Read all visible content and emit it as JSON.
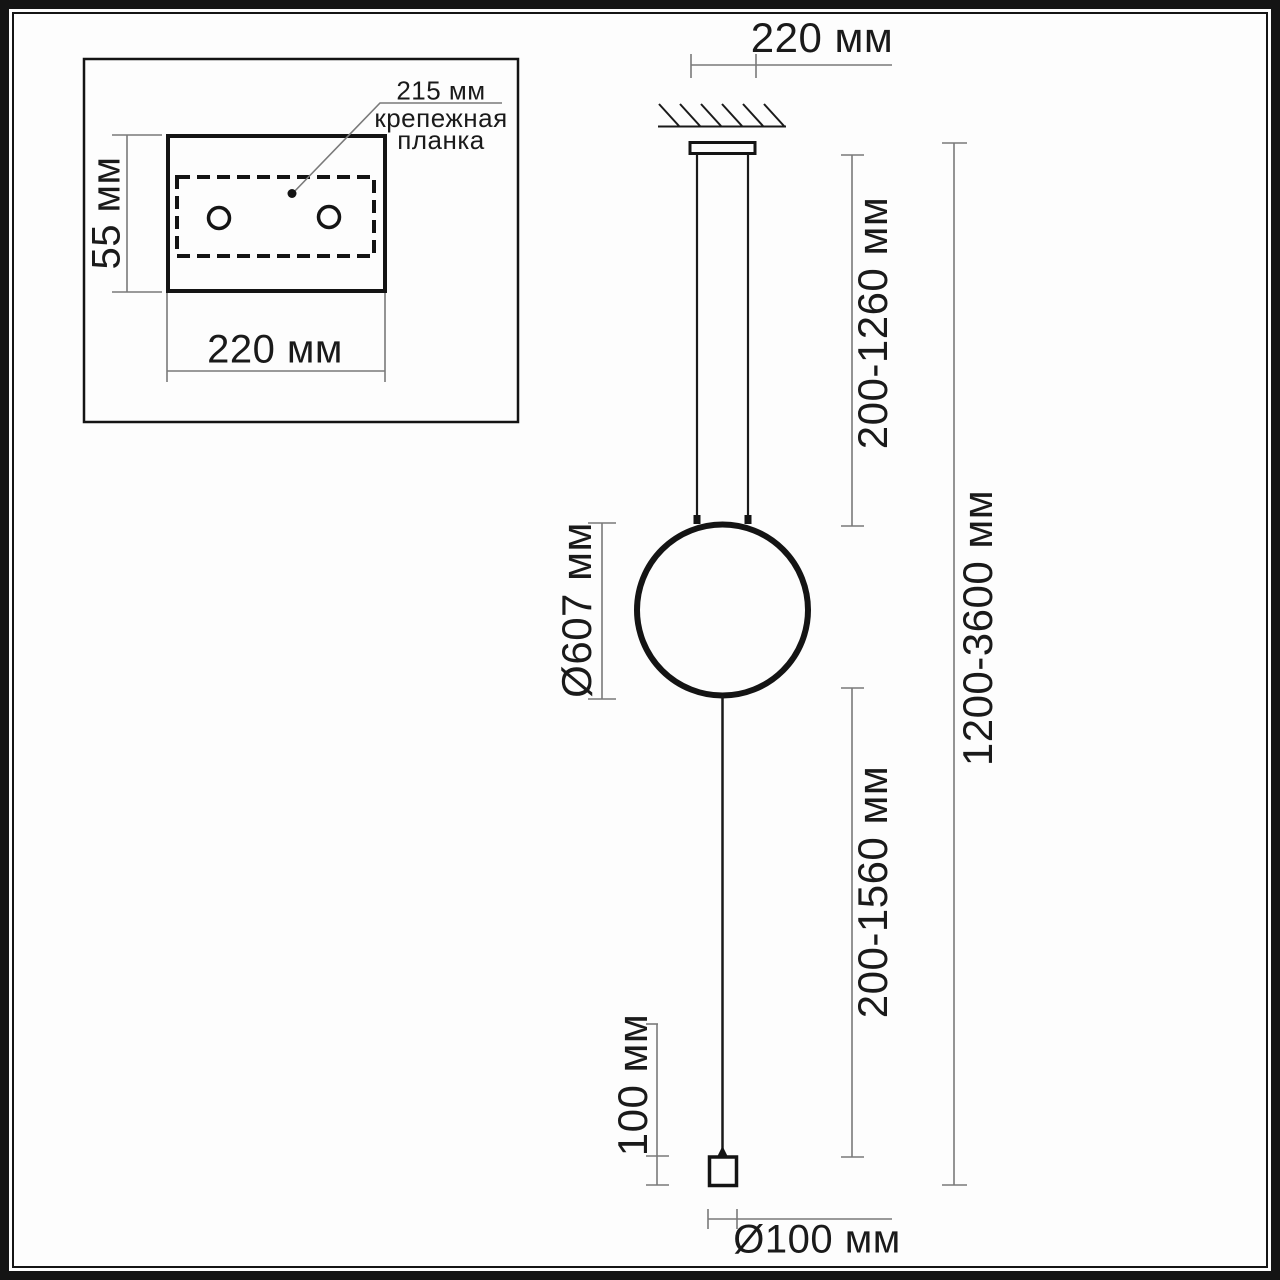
{
  "colors": {
    "line": "#1a1a1a",
    "dim_line": "#7a7a7a",
    "background": "#fdfdfd"
  },
  "inset": {
    "plate_length_label": "215 мм",
    "plate_name_line1": "крепежная",
    "plate_name_line2": "планка",
    "plate_height_dim": "55 мм",
    "plate_width_dim": "220 мм"
  },
  "main": {
    "canopy_width_dim": "220 мм",
    "upper_suspension_dim": "200-1260 мм",
    "ring_diameter_dim": "Ø607 мм",
    "lower_suspension_dim": "200-1560 мм",
    "total_height_dim": "1200-3600 мм",
    "floor_weight_height_dim": "100 мм",
    "floor_weight_diameter_dim": "Ø100 мм"
  }
}
